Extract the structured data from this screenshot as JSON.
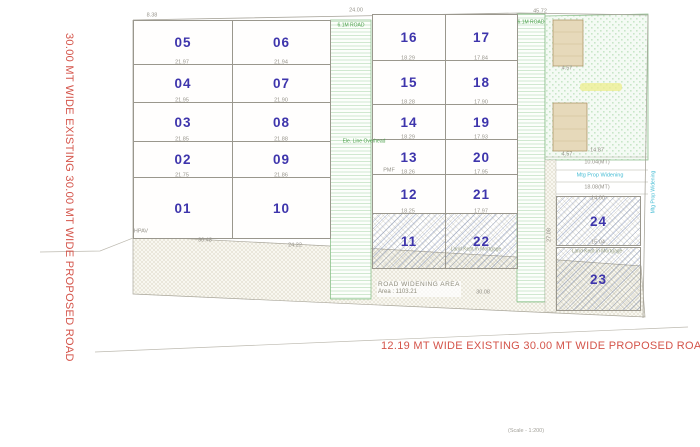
{
  "drawing": {
    "scale_note": "(Scale - 1:200)",
    "left_road_label": "30.00 MT WIDE EXISTING 30.00 MT WIDE PROPOSED ROAD",
    "bottom_road_label": "12.19 MT WIDE EXISTING 30.00 MT WIDE PROPOSED ROAD",
    "road_widening_title": "ROAD WIDENING AREA",
    "road_widening_area": "Area : 1103.21",
    "internal_road_label_1": "6.1M ROAD",
    "internal_road_label_2": "6.1M ROAD",
    "colors": {
      "plot_number": "#3e35ac",
      "road_text": "#d4544a",
      "internal_road_green": "#7fbb7f",
      "open_space_green": "#8cbf8c",
      "cyan_note": "#45bcd4",
      "dim_text": "#96938a",
      "building_fill": "#e6d9ba"
    }
  },
  "plots": [
    "01",
    "02",
    "03",
    "04",
    "05",
    "06",
    "07",
    "08",
    "09",
    "10",
    "11",
    "12",
    "13",
    "14",
    "15",
    "16",
    "17",
    "18",
    "19",
    "20",
    "21",
    "22",
    "23",
    "24"
  ],
  "dims": [
    "8.38",
    "24.00",
    "45.72",
    "21.97",
    "21.95",
    "21.85",
    "21.75",
    "30.48",
    "21.94",
    "21.90",
    "21.88",
    "21.86",
    "24.22",
    "18.29",
    "18.28",
    "18.29",
    "18.26",
    "18.25",
    "17.84",
    "17.90",
    "17.93",
    "17.95",
    "17.97",
    "14.87",
    "10.04(MT)",
    "18.08(MT)",
    "14.00",
    "15.04",
    "27.08",
    "30.08",
    "4.57",
    "4.57"
  ],
  "annotations": {
    "land_mortgage_1": "Land Kept in Mortgage",
    "land_mortgage_2": "Land Kept in Mortgage",
    "mtg_widening": "Mtg Prop Widening",
    "mtg_widening_vertical": "Mtg Prop Widening",
    "ele_line": "Ele. Line Overhead",
    "pmf": "PMF",
    "hpav": "HPAV"
  }
}
